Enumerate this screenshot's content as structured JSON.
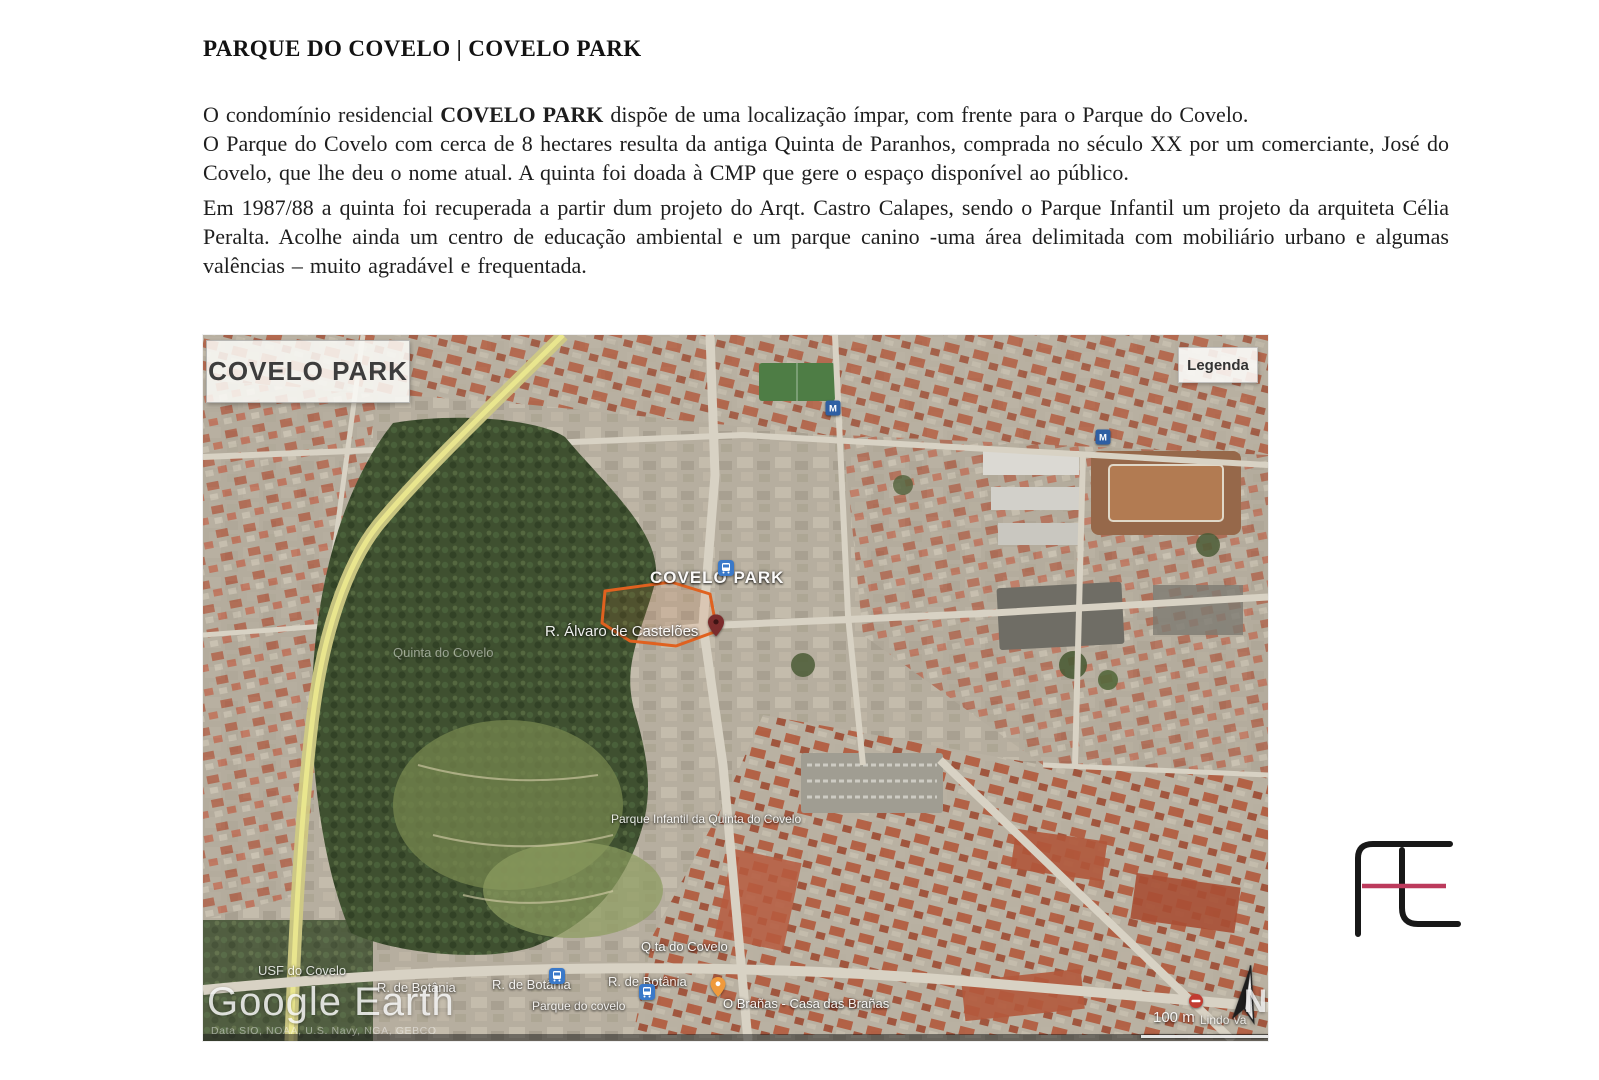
{
  "document": {
    "title": "PARQUE DO COVELO | COVELO PARK",
    "paragraphs": [
      {
        "before_bold": "O condomínio residencial ",
        "bold": "COVELO PARK",
        "after_bold": " dispõe de uma localização ímpar, com frente para o Parque do Covelo."
      },
      {
        "text": "O Parque do Covelo com cerca de 8 hectares resulta da antiga Quinta de Paranhos, comprada no século XX por um comerciante, José do Covelo, que lhe deu o nome atual. A quinta foi doada à CMP que gere o espaço disponível ao público."
      },
      {
        "text": "Em 1987/88 a quinta foi recuperada a partir dum projeto do Arqt. Castro Calapes, sendo o Parque Infantil um projeto da arquiteta Célia Peralta. Acolhe ainda um centro de educação ambiental e um parque canino -uma área delimitada com mobiliário urbano e algumas valências – muito agradável e frequentada."
      }
    ]
  },
  "map": {
    "title_overlay": "COVELO PARK",
    "legend_label": "Legenda",
    "watermark": "Google Earth",
    "attribution": "Data SIO, NOAA, U.S. Navy, NGA, GEBCO",
    "scale_label": "100 m",
    "north_label": "N",
    "colors": {
      "park_green": "#3f5030",
      "roof_orange": "#b2593c",
      "site_outline": "#e0611f",
      "road_yellow": "#ece98f",
      "transit_blue": "#2e5fa3"
    },
    "labels": [
      {
        "id": "site-name",
        "text": "COVELO PARK",
        "x": 447,
        "y": 233,
        "size": 17,
        "weight": 700,
        "opacity": 0.95,
        "spacing": 1
      },
      {
        "id": "street-alvaro",
        "text": "R. Álvaro de Castelões",
        "x": 342,
        "y": 288,
        "size": 15,
        "weight": 400,
        "opacity": 0.92
      },
      {
        "id": "quinta-do-covelo",
        "text": "Quinta do Covelo",
        "x": 190,
        "y": 310,
        "size": 13,
        "weight": 400,
        "opacity": 0.45
      },
      {
        "id": "parque-infantil",
        "text": "Parque Infantil da Quinta do Covelo",
        "x": 408,
        "y": 477,
        "size": 12,
        "weight": 400,
        "opacity": 0.85
      },
      {
        "id": "qta-do-covelo",
        "text": "Q.ta do Covelo",
        "x": 438,
        "y": 604,
        "size": 13,
        "weight": 400,
        "opacity": 0.9
      },
      {
        "id": "usf-do-covelo",
        "text": "USF do Covelo",
        "x": 55,
        "y": 628,
        "size": 13,
        "weight": 400,
        "opacity": 0.8
      },
      {
        "id": "botania-1",
        "text": "R. de Botânia",
        "x": 174,
        "y": 645,
        "size": 13,
        "weight": 400,
        "opacity": 0.85
      },
      {
        "id": "botania-2",
        "text": "R. de Botânia",
        "x": 289,
        "y": 642,
        "size": 13,
        "weight": 400,
        "opacity": 0.85
      },
      {
        "id": "botania-3",
        "text": "R. de Botânia",
        "x": 405,
        "y": 639,
        "size": 13,
        "weight": 400,
        "opacity": 0.85
      },
      {
        "id": "parque-covelo",
        "text": "Parque do covelo",
        "x": 329,
        "y": 664,
        "size": 12,
        "weight": 400,
        "opacity": 0.85
      },
      {
        "id": "branas",
        "text": "O Brañas - Casa das Brañas",
        "x": 520,
        "y": 661,
        "size": 13,
        "weight": 400,
        "opacity": 0.9
      },
      {
        "id": "lindo-vale",
        "text": "Lindo Va",
        "x": 997,
        "y": 678,
        "size": 12,
        "weight": 400,
        "opacity": 0.7
      }
    ],
    "icons": [
      {
        "type": "metro",
        "x": 630,
        "y": 73
      },
      {
        "type": "metro",
        "x": 900,
        "y": 102
      },
      {
        "type": "bus",
        "x": 523,
        "y": 233
      },
      {
        "type": "bus",
        "x": 354,
        "y": 641
      },
      {
        "type": "bus",
        "x": 444,
        "y": 657
      },
      {
        "type": "pin",
        "x": 513,
        "y": 300
      },
      {
        "type": "balloon",
        "x": 515,
        "y": 652
      },
      {
        "type": "noentry",
        "x": 993,
        "y": 666
      }
    ]
  },
  "logo": {
    "stroke": "#181818",
    "accent": "#bc3a5c"
  }
}
